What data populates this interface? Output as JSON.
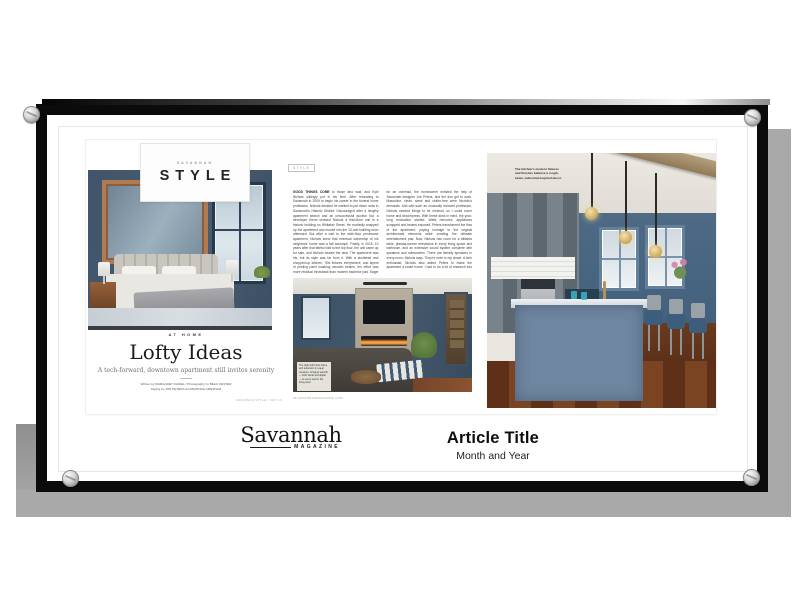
{
  "style_card": {
    "kicker": "SAVANNAH",
    "title": "STYLE"
  },
  "left_page": {
    "section": "AT HOME",
    "title": "Lofty Ideas",
    "subtitle": "A tech-forward, downtown apartment still invites serenity",
    "credit_line1": "Written by MARGARET DANIEL / Photography by BEAU KESTER",
    "credit_line2": "Styling by JON PETERS and BROOKE GRESHAM",
    "footer": "SAVANNAH STYLE | NOV 19"
  },
  "article_page": {
    "tag": "STYLE",
    "body_lead": "GOOD THINGS COME",
    "body_rest": " to those who wait, and Kyle Nichols willingly put in his time. After relocating to Savannah in 2009 to begin his career in the funeral home profession, Nichols decided he wanted to put down roots in Savannah's Historic District. Discouraged after a lengthy apartment search and an unsuccessful auction bid, a developer friend showed Nichols a third-floor unit in a historic building on Whitaker Street. He excitedly snapped up the apartment and moved into the 10-unit building soon afterward. But after a visit to the sixth-floor penthouse apartment, Nichols knew that eventual ownership of his neighbors' home was a fait accompli. Finally, in 2015, 10 years after that fateful visit to the top floor, the unit came up for sale, and Nichols sealed the deal. The apartment was his, but its style was far from it. With a shuttered and chopped-up kitchen, '90s fixtures everywhere, and layers of peeling paint masking wooden beams, the effort was more residual throwback than modern bachelor pad. Eager for an overhaul, the homeowner enlisted the help of Savannah designer Joe Peters, and the duo got to work. Masculine, clean, sleek and clutter-free were Nichols's demands. And with such an unusually involved profession, Nichols needed things to be minimal, so I could come home and decompress. With these aims in mind, the year-long renovation started. Walls removed, appliances scrapped and beams exposed, Peters transformed the flow of the apartment, paying homage to the original architectural elements while creating the ultimate entertainment pad. Now, Nichols has room for a billiards table, plasma-screen televisions in every living space and bathroom, and an extensive sound system complete with speakers and subwoofers. There are literally speakers in every room, Nichols says. They're even in my closet. A tech enthusiast, Nichols also asked Peters to make the apartment a smart home. I had to do a lot of research into smart switches and appliances to see how all this stuff worked, Peters recalls.",
    "photo_caption": "The high wall hosts flame and television in equal measure, bringing warmth — both literal and digital — to every seat in the living area.",
    "footer": "58   SAVANNAHMAGAZINE.COM"
  },
  "kitchen_page": {
    "caption": "The kitchen's modern fixtures and finishes balance a rough-hewn, industrial-inspired decor."
  },
  "bottom": {
    "logo_text": "Savannah",
    "logo_sub": "MAGAZINE",
    "article_title": "Article Title",
    "article_date": "Month and Year"
  },
  "colors": {
    "frame_black": "#0b0b0b",
    "shadow_gray": "#a9a9a9",
    "mat_white": "#ffffff",
    "wall_blue": "#44586c",
    "copper_accent": "#b07a52"
  }
}
